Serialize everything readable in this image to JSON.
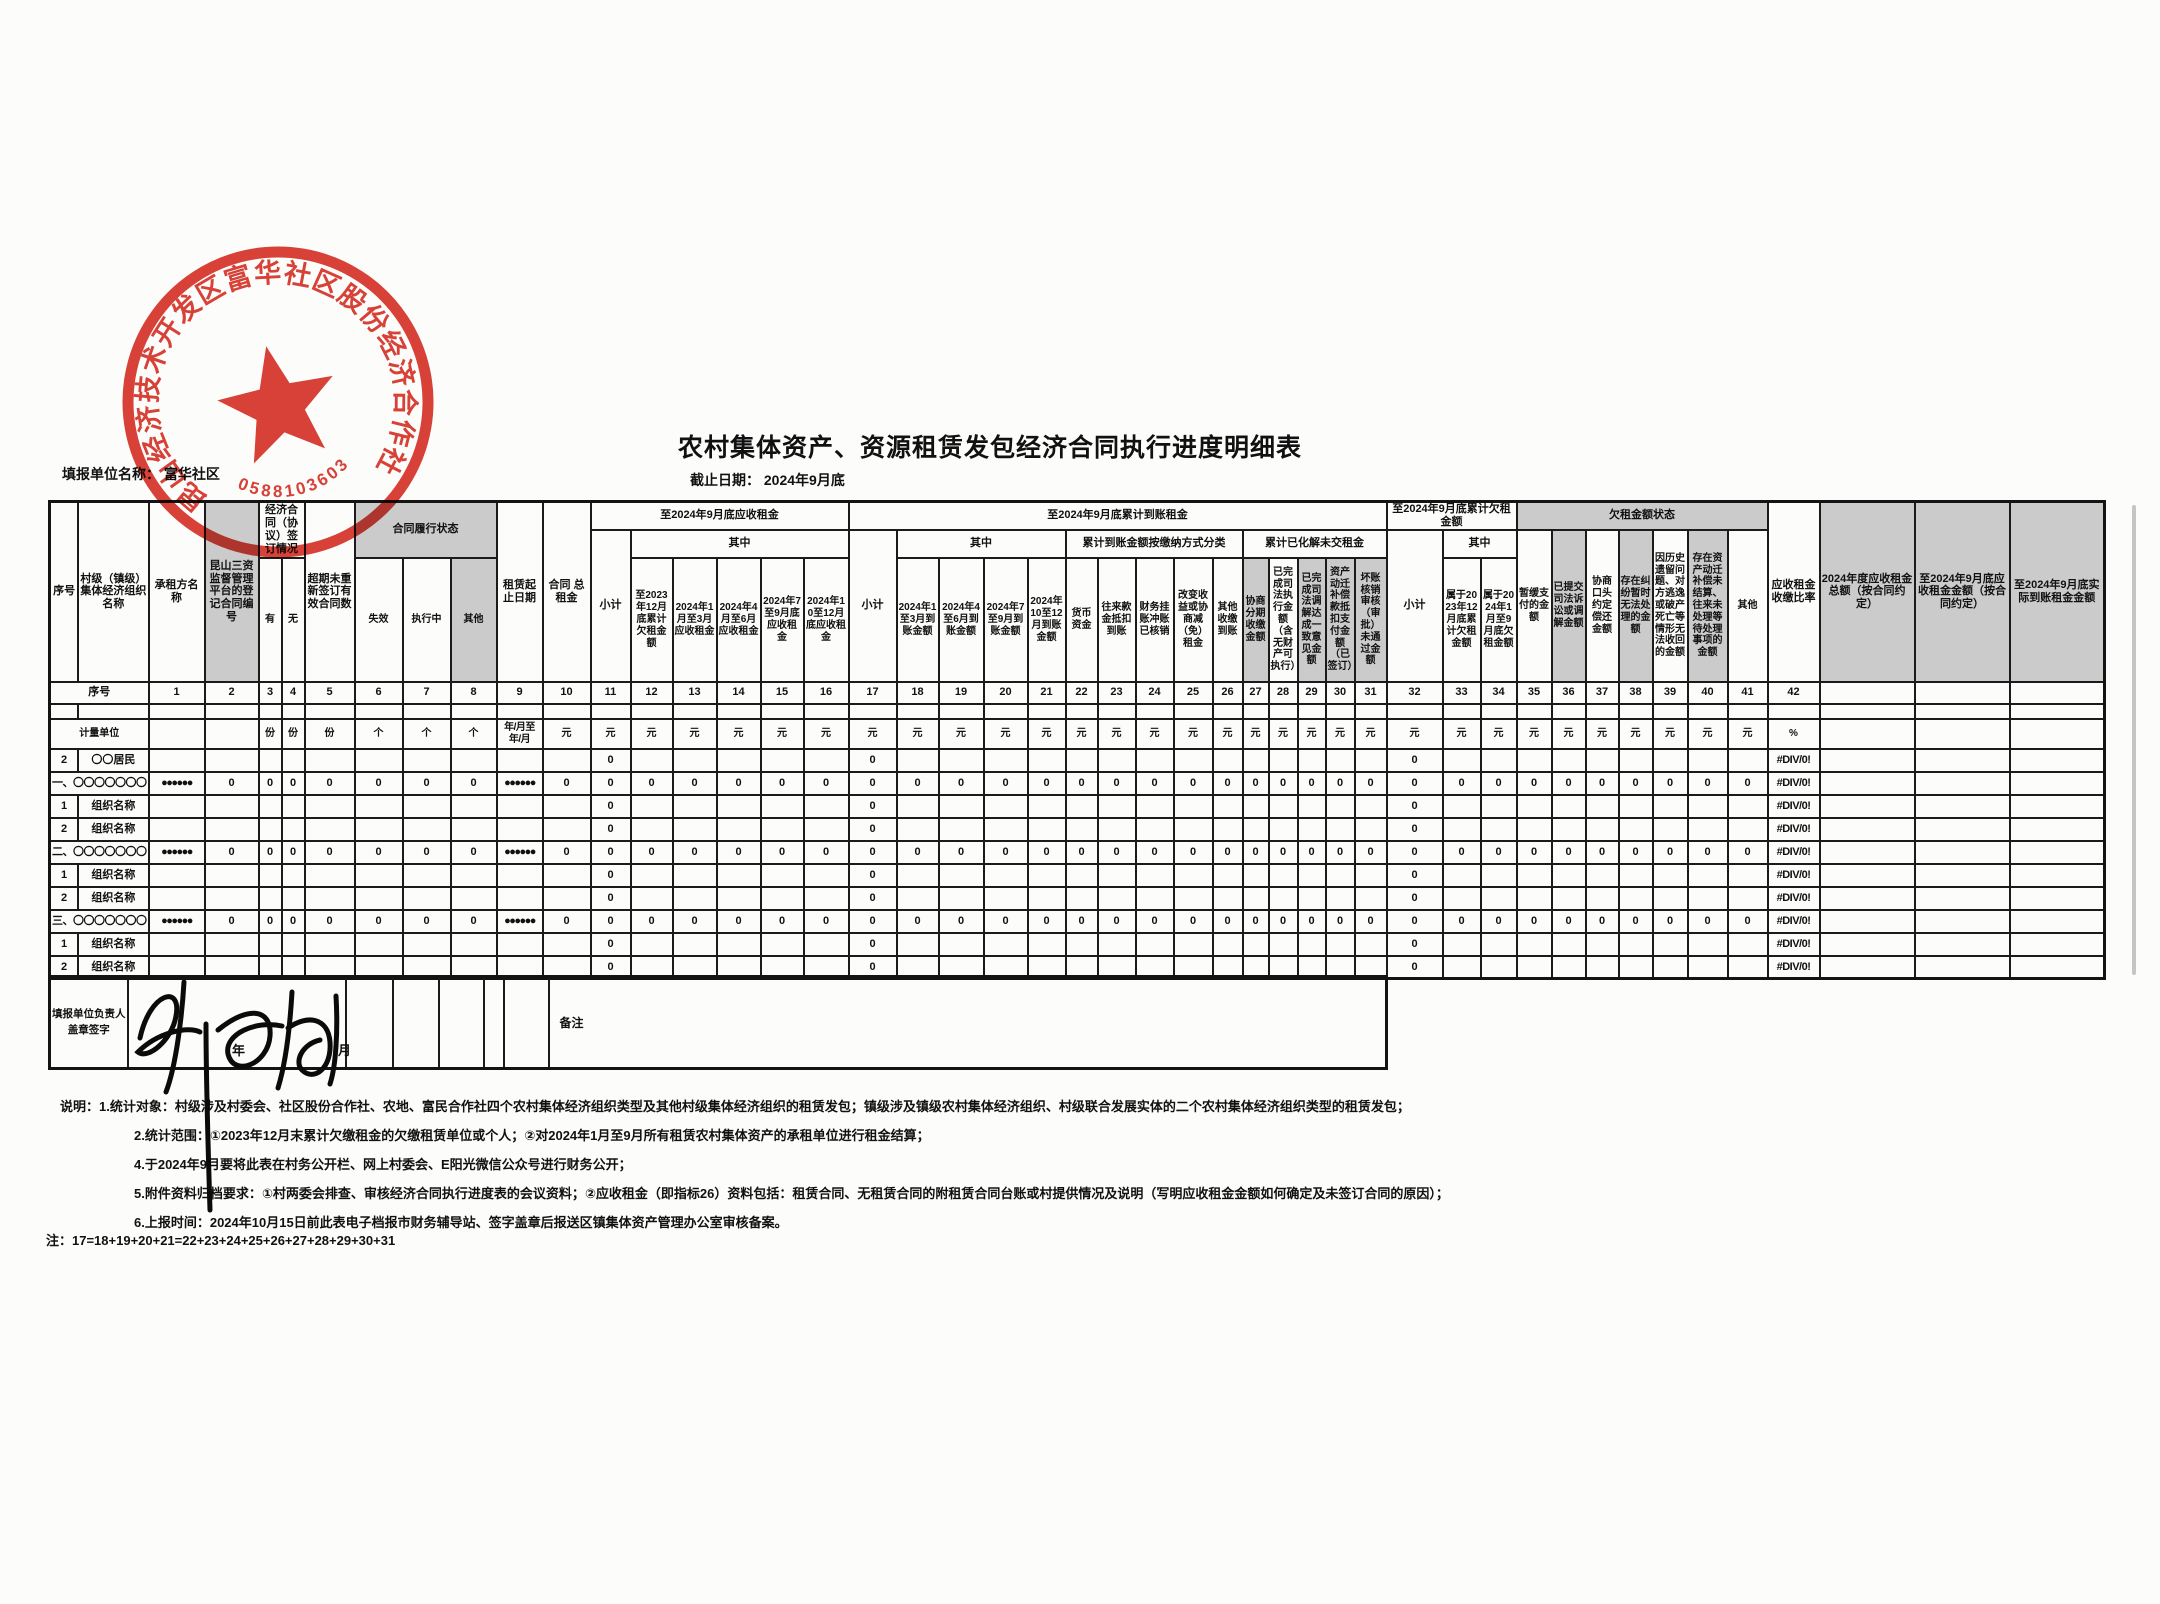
{
  "meta": {
    "title": "农村集体资产、资源租赁发包经济合同执行进度明细表",
    "fill_unit_label": "填报单位名称：",
    "fill_unit_value": "富华社区",
    "deadline_label": "截止日期：",
    "deadline_value": "2024年9月底"
  },
  "stamp": {
    "org_text": "昆山经济技术开发区富华社区股份经济合作社",
    "number": "0588103603",
    "color": "#d5281c"
  },
  "footer": {
    "label": "填报单位负责人盖章签字",
    "remark_label": "备注",
    "year_month": "年　月"
  },
  "notes": {
    "prefix": "说明：",
    "lines": [
      "1.统计对象：村级涉及村委会、社区股份合作社、农地、富民合作社四个农村集体经济组织类型及其他村级集体经济组织的租赁发包；镇级涉及镇级农村集体经济组织、村级联合发展实体的二个农村集体经济组织类型的租赁发包；",
      "2.统计范围：①2023年12月末累计欠缴租金的欠缴租赁单位或个人；②对2024年1月至9月所有租赁农村集体资产的承租单位进行租金结算；",
      "4.于2024年9月要将此表在村务公开栏、网上村委会、E阳光微信公众号进行财务公开；",
      "5.附件资料归档要求：①村两委会排查、审核经济合同执行进度表的会议资料；②应收租金（即指标26）资料包括：租赁合同、无租赁合同的附租赁合同台账或村提供情况及说明（写明应收租金金额如何确定及未签订合同的原因）；",
      "6.上报时间：2024年10月15日前此表电子档报市财务辅导站、签字盖章后报送区镇集体资产管理办公室审核备案。"
    ],
    "formula": "注：17=18+19+20+21=22+23+24+25+26+27+28+29+30+31"
  },
  "table": {
    "header_rows": [
      [
        {
          "t": "序号",
          "rs": 3
        },
        {
          "t": "村级（镇级）集体经济组织名称",
          "rs": 3
        },
        {
          "t": "承租方名称",
          "rs": 3
        },
        {
          "t": "昆山三资监督管理平台的登记合同编号",
          "rs": 3,
          "sh": 1
        },
        {
          "t": "经济合同（协议）签订情况",
          "cs": 2,
          "rs": 2
        },
        {
          "t": "超期未重新签订有效合同数",
          "rs": 3
        },
        {
          "t": "合同履行状态",
          "cs": 3,
          "rs": 2,
          "sh": 1
        },
        {
          "t": "租赁起止日期",
          "rs": 3
        },
        {
          "t": "合同 总租金",
          "rs": 3
        },
        {
          "t": "至2024年9月底应收租金",
          "cs": 6
        },
        {
          "t": "至2024年9月底累计到账租金",
          "cs": 15
        },
        {
          "t": "至2024年9月底累计欠租金额",
          "cs": 3
        },
        {
          "t": "欠租金额状态",
          "cs": 7,
          "sh": 1
        },
        {
          "t": "应收租金收缴比率",
          "rs": 3
        },
        {
          "t": "2024年度应收租金总额（按合同约定）",
          "rs": 3,
          "sh": 1
        },
        {
          "t": "至2024年9月底应收租金金额（按合同约定）",
          "rs": 3,
          "sh": 1
        },
        {
          "t": "至2024年9月底实际到账租金金额",
          "rs": 3,
          "sh": 1
        }
      ],
      [
        {
          "t": "小计",
          "rs": 2
        },
        {
          "t": "其中",
          "cs": 5
        },
        {
          "t": "小计",
          "rs": 2
        },
        {
          "t": "其中",
          "cs": 4
        },
        {
          "t": "累计到账金额按缴纳方式分类",
          "cs": 5
        },
        {
          "t": "累计已化解未交租金",
          "cs": 5
        },
        {
          "t": "小计",
          "rs": 2
        },
        {
          "t": "其中",
          "cs": 2
        },
        {
          "t": "暂缓支付的金额",
          "rs": 2,
          "lf": 1
        },
        {
          "t": "已提交司法诉讼或调解金额",
          "rs": 2,
          "lf": 1,
          "sh": 1
        },
        {
          "t": "协商口头约定偿还金额",
          "rs": 2,
          "lf": 1
        },
        {
          "t": "存在纠纷暂时无法处理的金额",
          "rs": 2,
          "lf": 1,
          "sh": 1
        },
        {
          "t": "因历史遗留问题、对方逃逸或破产死亡等情形无法收回的金额",
          "rs": 2,
          "lf": 1
        },
        {
          "t": "存在资产动迁补偿未结算、往来未处理等待处理事项的金额",
          "rs": 2,
          "lf": 1,
          "sh": 1
        },
        {
          "t": "其他",
          "rs": 2,
          "lf": 1
        }
      ],
      [
        {
          "t": "有"
        },
        {
          "t": "无"
        },
        {
          "t": "失效"
        },
        {
          "t": "执行中"
        },
        {
          "t": "其他",
          "sh": 1
        },
        {
          "t": "至2023年12月底累计欠租金额"
        },
        {
          "t": "2024年1月至3月应收租金"
        },
        {
          "t": "2024年4月至6月应收租金"
        },
        {
          "t": "2024年7至9月底应收租金"
        },
        {
          "t": "2024年10至12月底应收租金"
        },
        {
          "t": "2024年1至3月到账金额"
        },
        {
          "t": "2024年4至6月到账金额"
        },
        {
          "t": "2024年7至9月到账金额"
        },
        {
          "t": "2024年10至12月到账金额"
        },
        {
          "t": "货币资金"
        },
        {
          "t": "往来款金抵扣到账"
        },
        {
          "t": "财务挂账冲账已核销"
        },
        {
          "t": "改变收益或协商减（免）租金"
        },
        {
          "t": "其他收缴到账"
        },
        {
          "t": "协商分期收缴金额",
          "sh": 1
        },
        {
          "t": "已完成司法执行金额（含无财产可执行）"
        },
        {
          "t": "已完成司法调解达成一致意见金额",
          "sh": 1
        },
        {
          "t": "资产动迁补偿款抵扣支付金额（已签订）",
          "sh": 1
        },
        {
          "t": "坏账核销审核（审批）未通过金额",
          "sh": 1
        },
        {
          "t": "属于2023年12月底累计欠租金额"
        },
        {
          "t": "属于2024年1月至9月底欠租金额"
        }
      ]
    ],
    "number_row": {
      "label": "序号",
      "numbers": [
        "1",
        "2",
        "3",
        "4",
        "5",
        "6",
        "7",
        "8",
        "9",
        "10",
        "11",
        "12",
        "13",
        "14",
        "15",
        "16",
        "17",
        "18",
        "19",
        "20",
        "21",
        "22",
        "23",
        "24",
        "25",
        "26",
        "27",
        "28",
        "29",
        "30",
        "31",
        "32",
        "33",
        "34",
        "35",
        "36",
        "37",
        "38",
        "39",
        "40",
        "41",
        "42"
      ],
      "trailing_blanks": 3
    },
    "unit_row": {
      "label": "计量单位",
      "units": [
        "",
        "",
        "份",
        "份",
        "份",
        "个",
        "个",
        "个",
        "年/月至年/月",
        "元",
        "元",
        "元",
        "元",
        "元",
        "元",
        "元",
        "元",
        "元",
        "元",
        "元",
        "元",
        "元",
        "元",
        "元",
        "元",
        "元",
        "元",
        "元",
        "元",
        "元",
        "元",
        "元",
        "元",
        "元",
        "元",
        "元",
        "元",
        "元",
        "元",
        "元",
        "元",
        "%",
        "",
        "",
        ""
      ]
    },
    "rows": [
      {
        "sn": "2",
        "name": "〇〇居民",
        "type": "plain"
      },
      {
        "name": "一、〇〇〇〇〇〇〇",
        "type": "section"
      },
      {
        "sn": "1",
        "name": "组织名称",
        "type": "plain"
      },
      {
        "sn": "2",
        "name": "组织名称",
        "type": "plain"
      },
      {
        "name": "二、〇〇〇〇〇〇〇",
        "type": "section"
      },
      {
        "sn": "1",
        "name": "组织名称",
        "type": "plain"
      },
      {
        "sn": "2",
        "name": "组织名称",
        "type": "plain"
      },
      {
        "name": "三、〇〇〇〇〇〇〇",
        "type": "section"
      },
      {
        "sn": "1",
        "name": "组织名称",
        "type": "plain"
      },
      {
        "sn": "2",
        "name": "组织名称",
        "type": "plain"
      }
    ],
    "plain_values": {
      "11": "0",
      "17": "0",
      "32": "0",
      "42": "#DIV/0!"
    },
    "section_values": {
      "1": "●●●●●●",
      "9": "●●●●●●",
      "42": "#DIV/0!"
    },
    "section_zero_cols": [
      2,
      3,
      4,
      5,
      6,
      7,
      8,
      10,
      11,
      12,
      13,
      14,
      15,
      16,
      17,
      18,
      19,
      20,
      21,
      22,
      23,
      24,
      25,
      26,
      27,
      28,
      29,
      30,
      31,
      32,
      33,
      34,
      35,
      36,
      37,
      38,
      39,
      40,
      41
    ]
  }
}
